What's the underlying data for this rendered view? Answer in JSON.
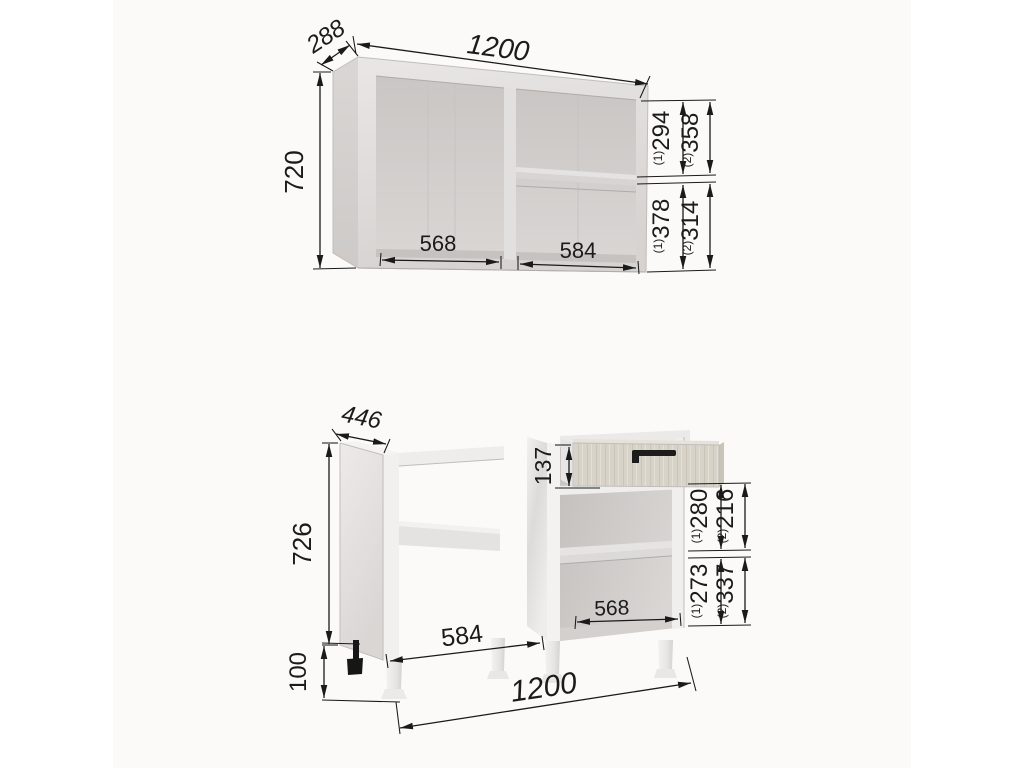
{
  "drawing": {
    "type": "furniture-dimension-diagram",
    "units": "mm"
  },
  "wall_cabinet": {
    "label": "wall cabinet",
    "width": "1200",
    "depth": "288",
    "height": "720",
    "left_opening_width": "568",
    "right_opening_width": "584",
    "upper_v1": "294",
    "upper_v2": "358",
    "lower_v1": "378",
    "lower_v2": "314",
    "sup1": "(1)",
    "sup2": "(2)"
  },
  "base_cabinet": {
    "label": "base cabinet",
    "width": "1200",
    "depth": "446",
    "height": "726",
    "leg_height": "100",
    "drawer_front_height": "137",
    "left_opening_width": "584",
    "right_opening_width": "568",
    "upper_v1": "280",
    "upper_v2": "216",
    "lower_v1": "273",
    "lower_v2": "337",
    "sup1": "(1)",
    "sup2": "(2)"
  },
  "colors": {
    "background": "#ffffff",
    "panel_background": "#fbfaf8",
    "dimension_ink": "#1a1a1a",
    "carcass_grey": "#d8d5d3",
    "gloss_white": "#f1f0ef",
    "wood_front": "#d8d3c9",
    "handle_black": "#1c1c1c"
  }
}
